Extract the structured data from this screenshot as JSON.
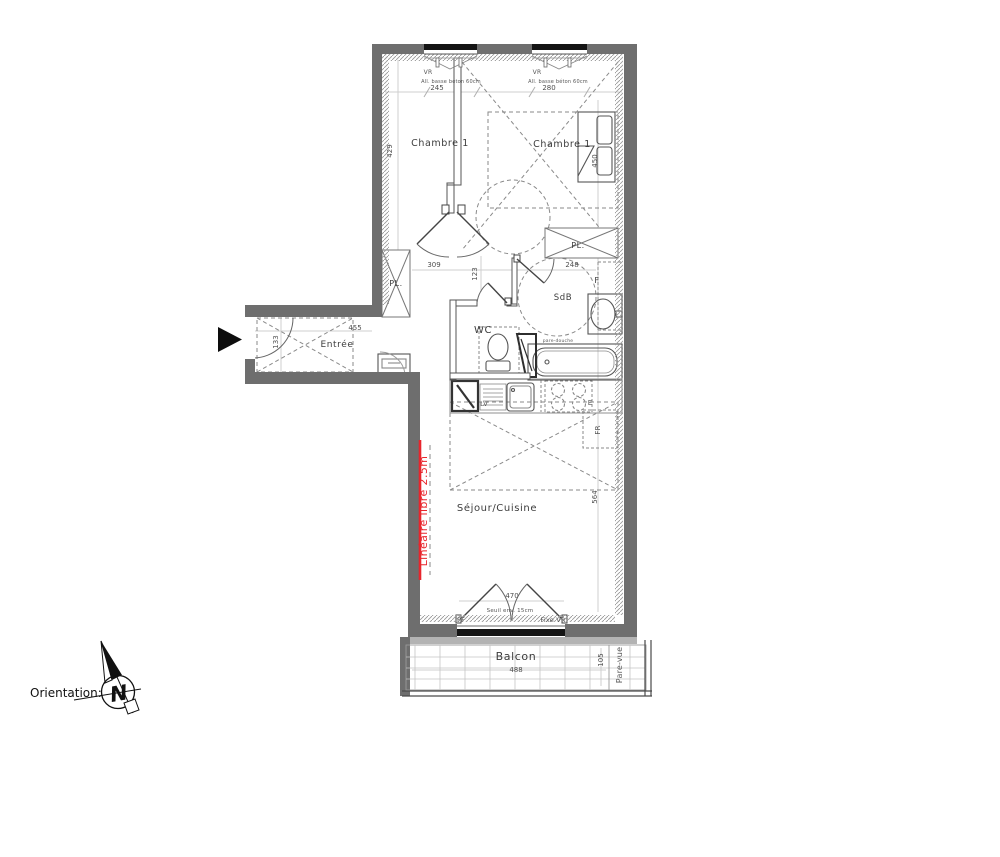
{
  "plan": {
    "rooms": {
      "chambre1": "Chambre 1",
      "chambre2": "Chambre 1",
      "entree": "Entrée",
      "wc": "WC",
      "sdb": "SdB",
      "sejour_cuisine": "Séjour/Cuisine",
      "balcon": "Balcon",
      "placard_left": "PL.",
      "placard_right": "PL."
    },
    "openings": {
      "vr_left": "VR",
      "vr_right": "VR",
      "allege_left": "All. basse béton 60cm",
      "allege_right": "All. basse béton 60cm",
      "fenetre": "F",
      "porte_fenetre": "PF",
      "fixe_vr": "Fixe  VR",
      "seuil": "Seuil env. 15cm"
    },
    "equipment": {
      "lave_vaisselle": "LV",
      "evier": "E",
      "frigo": "FR",
      "pare_douche": "pare-douche"
    },
    "dims": {
      "chambre1_w": "245",
      "chambre2_w": "280",
      "chambre1_h": "429",
      "lit": "450",
      "couloir": "309",
      "couloir_b": "123",
      "sdb_w": "248",
      "entree_w": "455",
      "entree_h": "133",
      "sejour_h": "564",
      "baie": "470",
      "balcon_w": "488",
      "balcon_d": "105"
    },
    "annotations": {
      "lineaire": "Linéaire libre 2.5m",
      "pare_vue": "Pare-vue",
      "orientation_label": "Orientation:",
      "north": "N"
    },
    "colors": {
      "wall": "#6e6e6e",
      "accent_red": "#e8262d"
    }
  }
}
